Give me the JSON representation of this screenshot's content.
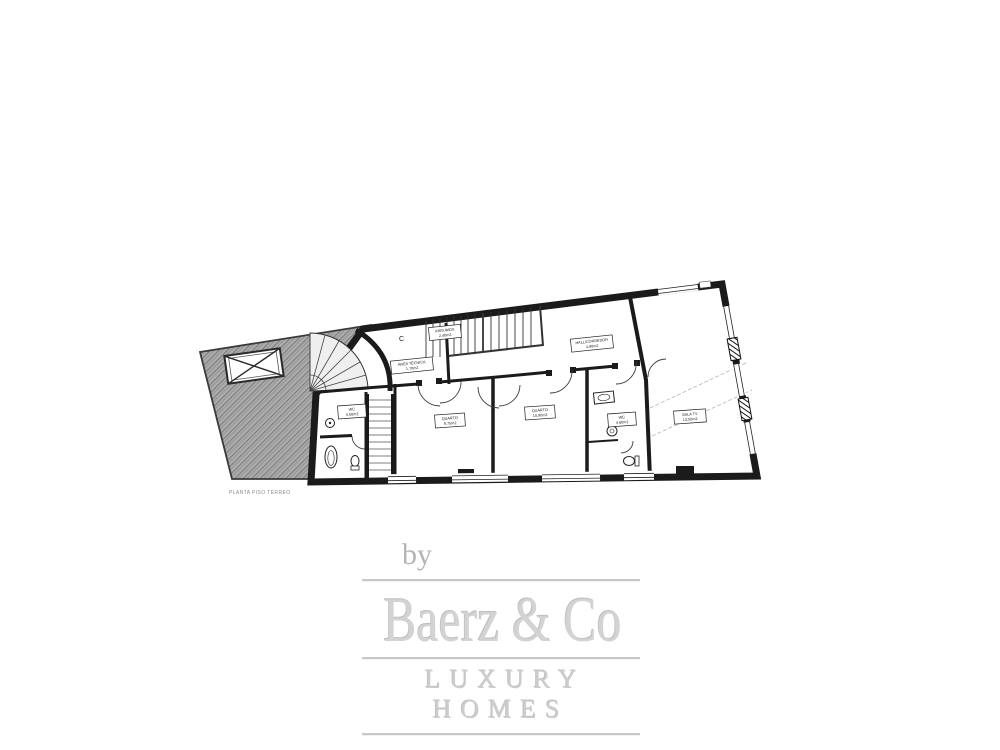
{
  "plan": {
    "caption": "PLANTA PISO TÉRREO",
    "letters": {
      "c": "C",
      "t": "T"
    },
    "rooms": {
      "area_tecnica": {
        "name": "ÁREA TÉCNICA",
        "area": "1,70m2"
      },
      "arrumos": {
        "name": "ARRUMOS",
        "area": "2,40m2"
      },
      "hall": {
        "name": "HALL/CORREDOR",
        "area": "4,90m2"
      },
      "wc_left": {
        "name": "WC",
        "area": "4,50m2"
      },
      "quarto1": {
        "name": "QUARTO",
        "area": "9,75m2"
      },
      "quarto2": {
        "name": "QUARTO",
        "area": "10,90m2"
      },
      "wc_mid": {
        "name": "WC",
        "area": "4,60m2"
      },
      "sala": {
        "name": "SALA TV",
        "area": "13,50m2"
      }
    }
  },
  "watermark": {
    "prefix": "by",
    "brand": "Baerz & Co",
    "tagline": "LUXURY HOMES"
  },
  "colors": {
    "wall": "#1b1b1b",
    "hatch_fill": "#ababab",
    "hatch_stroke": "#7a7a7a",
    "logo_text": "#d3d3d3",
    "logo_line": "#c8c8c8",
    "logo_by": "#b5b5b5",
    "caption_gray": "#8c8c8c"
  }
}
